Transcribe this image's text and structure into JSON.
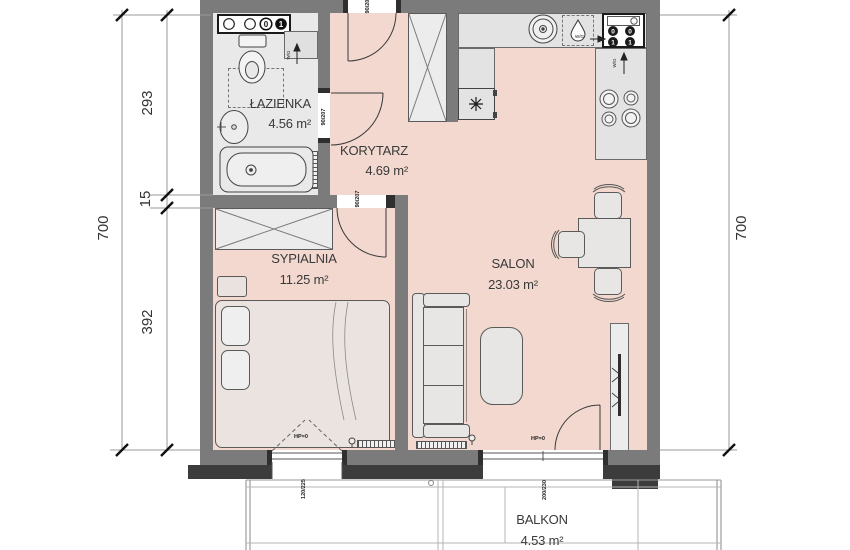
{
  "rooms": {
    "lazienka": {
      "name": "ŁAZIENKA",
      "area": "4.56 m²"
    },
    "korytarz": {
      "name": "KORYTARZ",
      "area": "4.69 m²"
    },
    "sypialnia": {
      "name": "SYPIALNIA",
      "area": "11.25 m²"
    },
    "salon": {
      "name": "SALON",
      "area": "23.03 m²"
    },
    "balkon": {
      "name": "BALKON",
      "area": "4.53 m²"
    }
  },
  "dimensions": {
    "left_total": "700",
    "left_seg1": "293",
    "left_seg2": "15",
    "left_seg3": "392",
    "right_total": "700"
  },
  "openings": {
    "entrance_door": "90/207",
    "bathroom_door": "90/207",
    "bedroom_door": "90/207",
    "bedroom_window": "120/225",
    "balcony_door": "200/230",
    "bedroom_window_hp": "HP=0",
    "balcony_door_hp": "HP=0"
  },
  "labels": {
    "wg_bathroom": "W/G",
    "wg_kitchen_top": "W/G",
    "wg_kitchen_right": "W/G"
  },
  "meters": {
    "shaft_zero": "0",
    "shaft_one": "1",
    "box_r1c1": "0",
    "box_r1c2": "0",
    "box_r2c1": "1",
    "box_r2c2": "1"
  },
  "colors": {
    "wall": "#7b7b7b",
    "wall_dark": "#3c3c3c",
    "floor_pink": "#f2d8cf",
    "floor_gray": "#e9e9e9",
    "line": "#555555"
  }
}
